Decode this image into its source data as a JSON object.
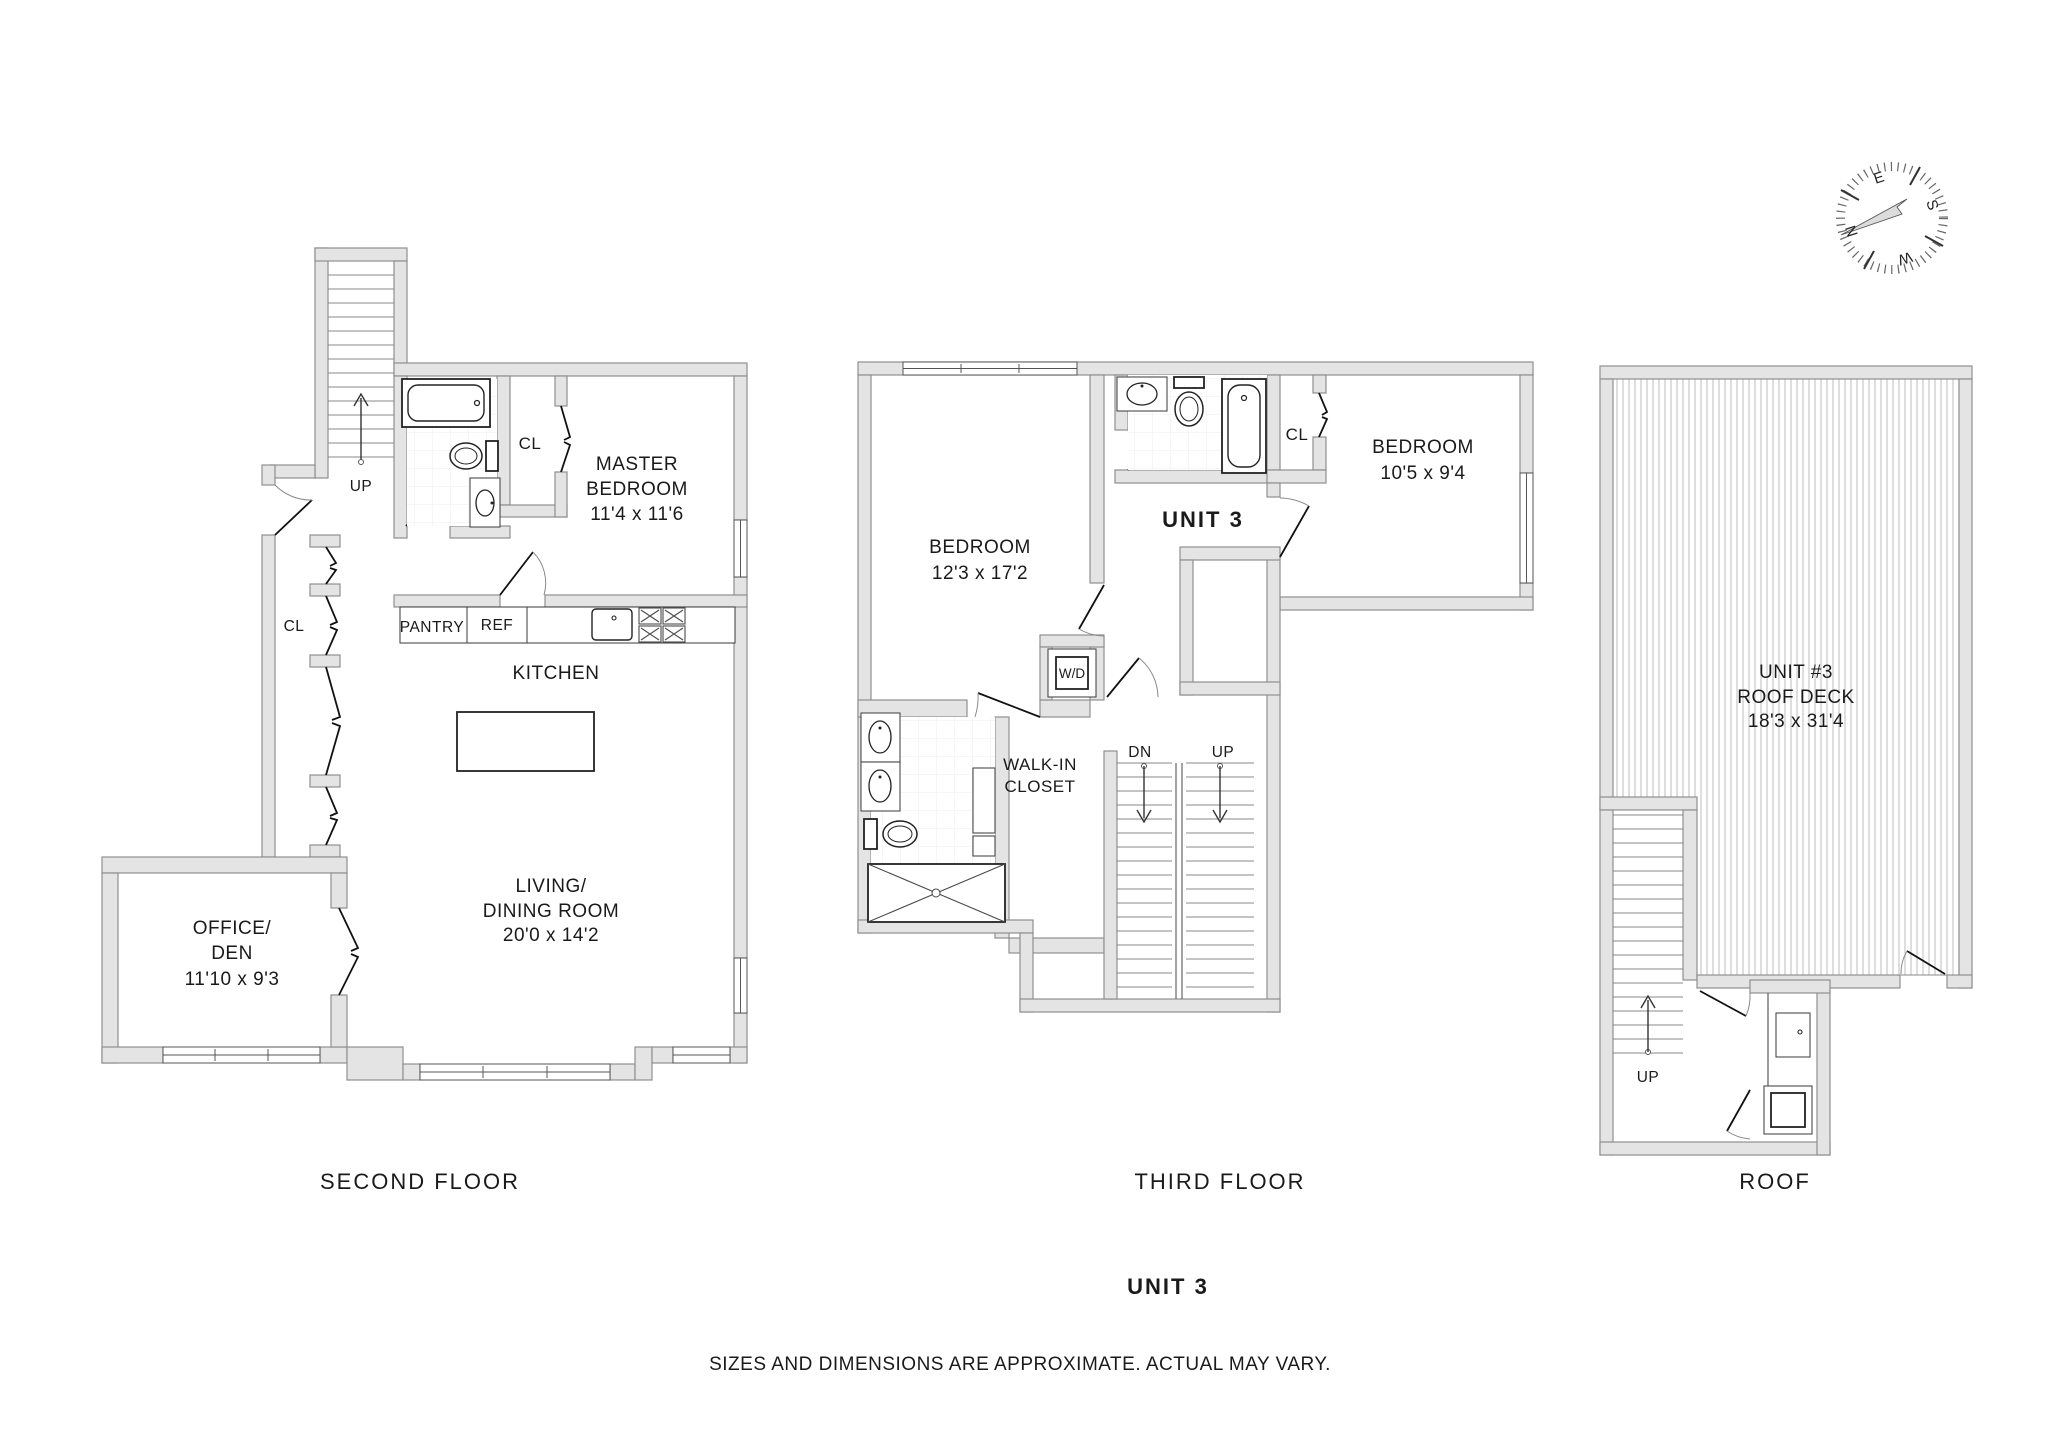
{
  "colors": {
    "wall_fill": "#e4e4e4",
    "wall_edge": "#8f8f8f",
    "line": "#222222",
    "deck_hatch": "#c9c9c9",
    "text": "#1a1a1a",
    "needle": "#dcdcdc"
  },
  "second_floor": {
    "title": "SECOND FLOOR",
    "up": "UP",
    "entry_closet": "CL",
    "master": {
      "line1": "MASTER",
      "line2": "BEDROOM",
      "dims": "11'4 x 11'6",
      "closet": "CL"
    },
    "kitchen": {
      "label": "KITCHEN",
      "pantry": "PANTRY",
      "fridge": "REF"
    },
    "living": {
      "line1": "LIVING/",
      "line2": "DINING ROOM",
      "dims": "20'0 x 14'2"
    },
    "office": {
      "line1": "OFFICE/",
      "line2": "DEN",
      "dims": "11'10 x 9'3"
    }
  },
  "third_floor": {
    "title": "THIRD FLOOR",
    "unit": "UNIT 3",
    "bedroom1": {
      "label": "BEDROOM",
      "dims": "12'3 x 17'2"
    },
    "bedroom2": {
      "label": "BEDROOM",
      "dims": "10'5 x 9'4",
      "closet": "CL"
    },
    "walk_in": {
      "line1": "WALK-IN",
      "line2": "CLOSET"
    },
    "laundry": "W/D",
    "down": "DN",
    "up": "UP"
  },
  "roof": {
    "title": "ROOF",
    "deck": {
      "line1": "UNIT #3",
      "line2": "ROOF DECK",
      "dims": "18'3 x 31'4"
    },
    "up": "UP"
  },
  "footer": {
    "unit": "UNIT 3",
    "disclaimer": "SIZES AND DIMENSIONS ARE APPROXIMATE. ACTUAL MAY VARY."
  },
  "compass": {
    "north": "N",
    "east": "E",
    "south": "S",
    "west": "W"
  }
}
